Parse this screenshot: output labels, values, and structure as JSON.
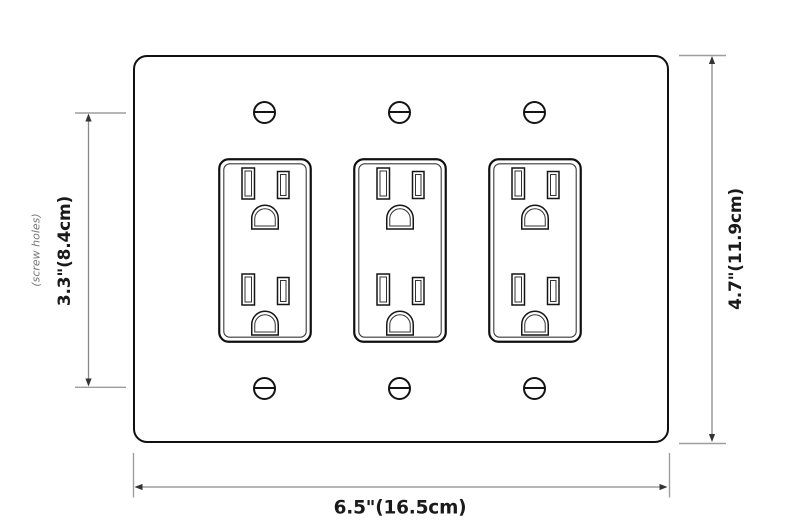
{
  "diagram": {
    "dimensions": {
      "plate_width": {
        "label": "6.5\"(16.5cm)"
      },
      "plate_height": {
        "label": "4.7\"(11.9cm)"
      },
      "screw_hole_spacing": {
        "label": "3.3\"(8.4cm)",
        "note": "(screw holes)"
      }
    },
    "counts": {
      "outlets": 3,
      "screws": 6
    },
    "colors": {
      "background": "#ffffff",
      "plate_outline": "#101010",
      "dimension_line": "#8a8a8a",
      "tick_line": "#9e9e9e",
      "arrowhead": "#333333",
      "label_text": "#1a1a1a",
      "note_text": "#777777"
    }
  }
}
